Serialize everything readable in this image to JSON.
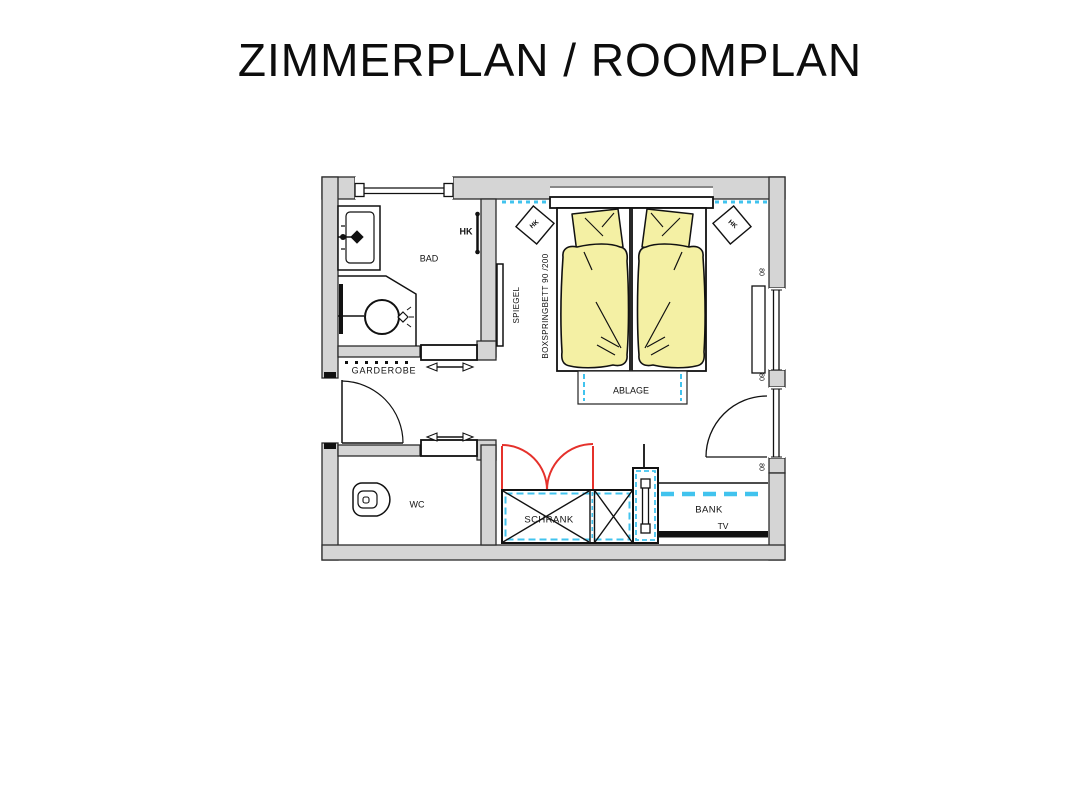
{
  "title": "ZIMMERPLAN / ROOMPLAN",
  "plan": {
    "bathroom": {
      "label": "BAD",
      "radiator_label": "HK"
    },
    "entry": {
      "wardrobe_label": "GARDEROBE"
    },
    "wc": {
      "label": "WC"
    },
    "bedroom": {
      "mirror_label": "SPIEGEL",
      "bed_label": "BOXSPRINGBETT 90 /200",
      "radiator_left_label": "HK",
      "radiator_right_label": "HK",
      "shelf_label": "ABLAGE"
    },
    "closet_label": "SCHRANK",
    "bench_label": "BANK",
    "tv_label": "TV",
    "window_dim_labels": [
      "80",
      "80",
      "80"
    ]
  },
  "colors": {
    "wall_fill": "#d5d5d5",
    "bed_fill": "#f4f0a4",
    "accent_cyan": "#41c3ee",
    "accent_red": "#e5312b",
    "line": "#111111",
    "background": "#ffffff"
  }
}
